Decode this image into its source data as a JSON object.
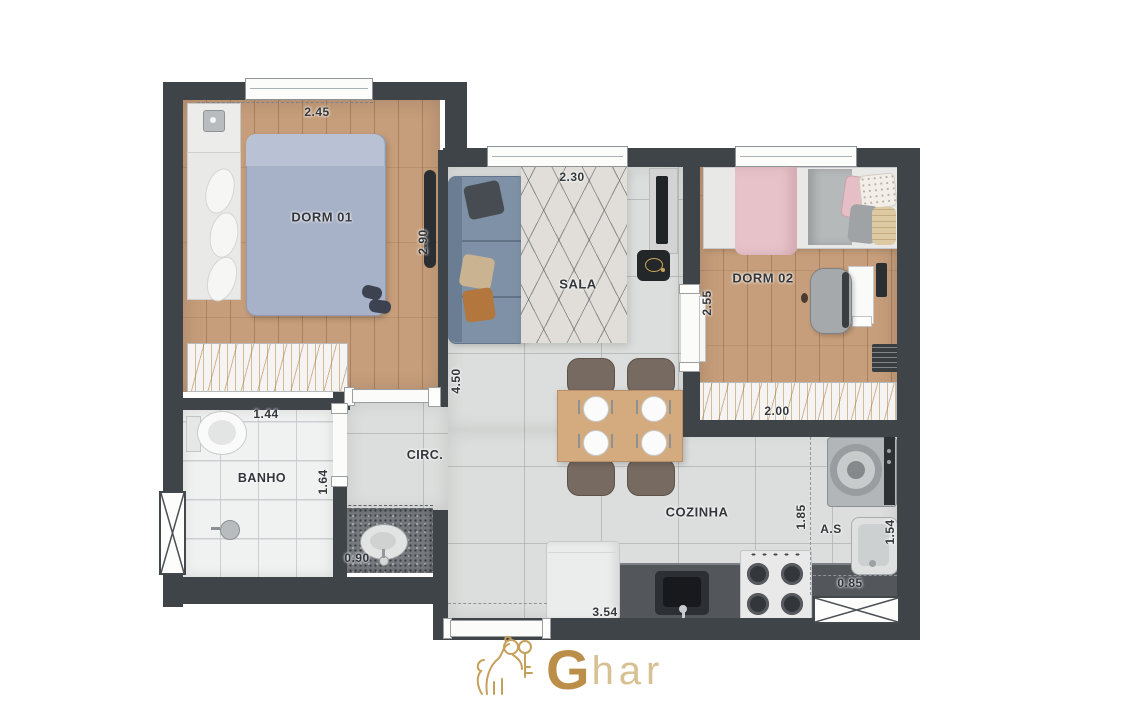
{
  "plan": {
    "type": "apartment-floor-plan",
    "rooms": {
      "dorm01": {
        "label": "DORM 01",
        "dim_width": "2.45",
        "dim_height": "2.90"
      },
      "sala": {
        "label": "SALA",
        "dim_width": "2.30",
        "dim_height": "4.50"
      },
      "dorm02": {
        "label": "DORM 02",
        "dim_height": "2.55",
        "dim_closet": "2.00"
      },
      "banho": {
        "label": "BANHO",
        "dim_width": "1.44",
        "dim_height": "1.64"
      },
      "lavatory": {
        "dim_width": "0.90"
      },
      "circ": {
        "label": "CIRC."
      },
      "cozinha": {
        "label": "COZINHA",
        "dim_height": "1.85",
        "dim_width": "3.54"
      },
      "servico": {
        "label": "A.S",
        "dim_height": "1.54",
        "dim_width": "0.85"
      }
    },
    "colors": {
      "wall": "#3f4449",
      "wood_floor": "#c69e7b",
      "tile_floor": "#dcdedd",
      "bath_floor": "#f0f1f1",
      "label_text": "#33373b",
      "logo_gold": "#bb8f49"
    }
  },
  "branding": {
    "logo_mark": "lion-and-key-icon",
    "logo_text_g": "G",
    "logo_text_rest": "har"
  }
}
